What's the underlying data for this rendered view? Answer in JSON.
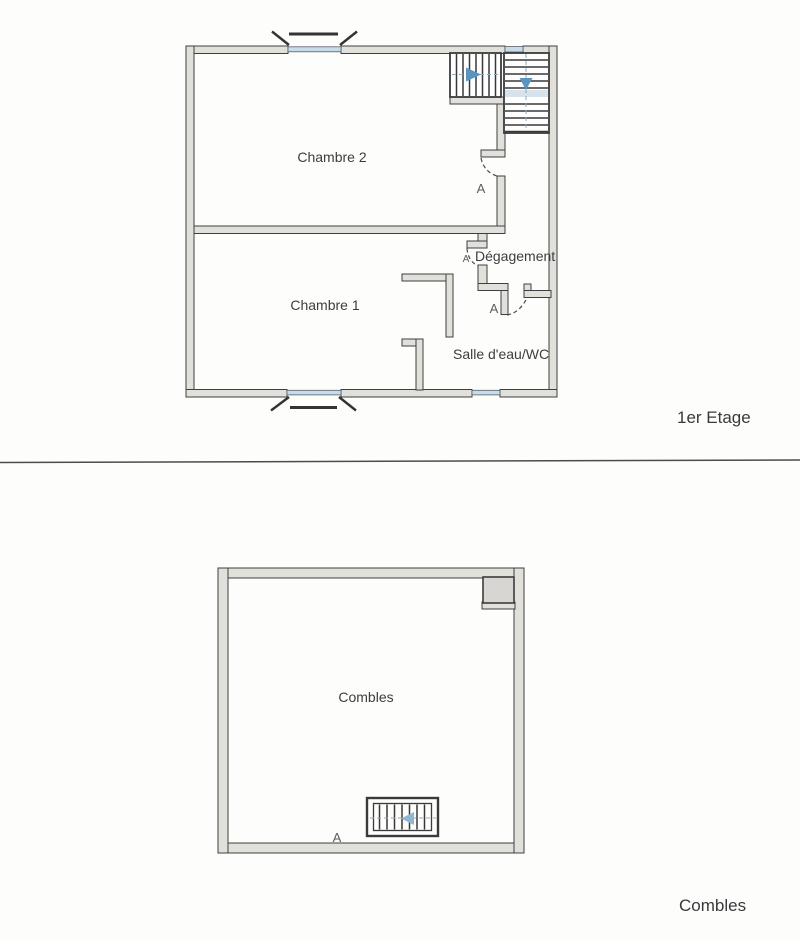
{
  "colors": {
    "wall_outline": "#3f3f3f",
    "wall_fill": "#e2e0da",
    "window_glass": "#c7dbe8",
    "stair_landing": "#d6e3ed",
    "stair_arrow_blue": "#5a94c0",
    "hatch_arrow_blue": "#8fb7d2",
    "chimney_fill": "#d7d6d2",
    "text": "#3d3d3f",
    "door_label_gray": "#5d5d5f"
  },
  "floor_plans": [
    {
      "caption": "1er Etage",
      "rooms": [
        {
          "label": "Chambre 2"
        },
        {
          "label": "Chambre 1"
        },
        {
          "label": "Dégagement"
        },
        {
          "label": "Salle d'eau/WC"
        }
      ],
      "door_label": "A",
      "stairs": [
        {
          "name": "upper-flight",
          "direction_icon": "arrow-right"
        },
        {
          "name": "lower-flight",
          "direction_icon": "arrow-down"
        }
      ],
      "windows": [
        "top-left-window",
        "stairwell-window",
        "bottom-left-window",
        "bottom-right-window"
      ]
    },
    {
      "caption": "Combles",
      "rooms": [
        {
          "label": "Combles"
        }
      ],
      "door_label": "A",
      "roof_hatch": {
        "direction_icon": "arrow-left"
      }
    }
  ]
}
